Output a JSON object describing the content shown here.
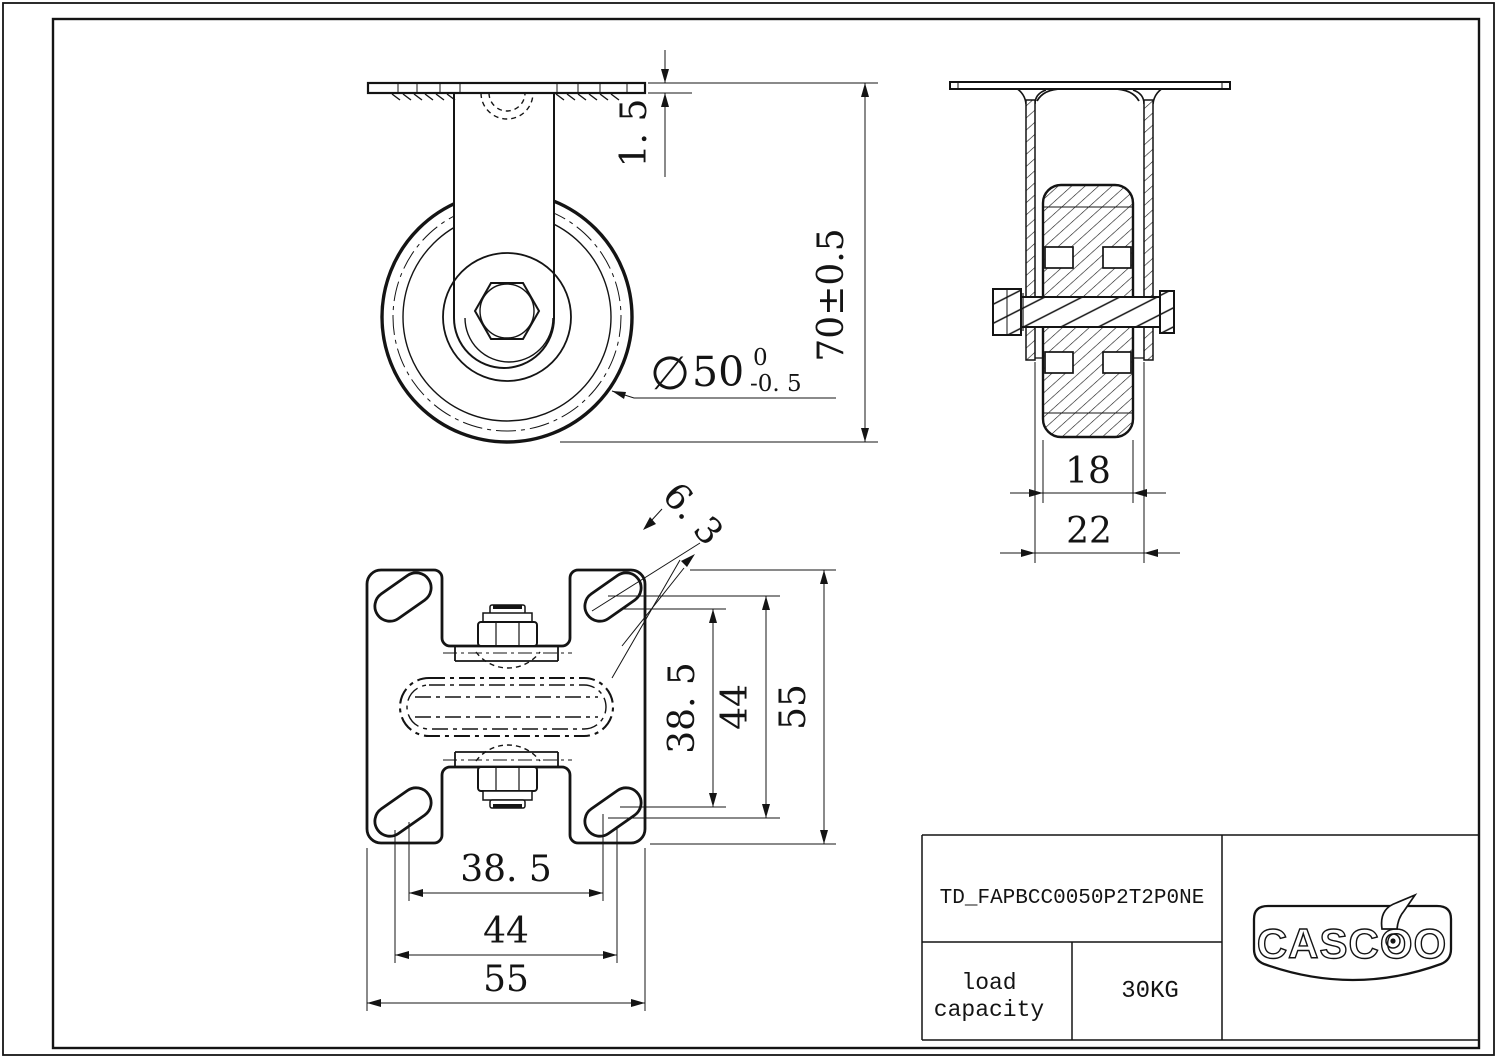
{
  "page": {
    "background": "#ffffff",
    "line_color": "#141414"
  },
  "front_view": {
    "dim_plate_thickness": "1. 5",
    "dim_overall_height": "70±0.5",
    "dim_wheel_diameter_symbol": "∅",
    "dim_wheel_diameter_value": "50",
    "dim_wheel_diameter_tol_upper": "0",
    "dim_wheel_diameter_tol_lower": "-0. 5"
  },
  "side_view": {
    "dim_wheel_width": "18",
    "dim_fork_span": "22"
  },
  "plate_view": {
    "dim_slot_width": "6. 3",
    "dim_bolt_pitch_vertical": "38. 5",
    "dim_slot_span_vertical": "44",
    "dim_plate_size_vertical": "55",
    "dim_bolt_pitch_horizontal": "38. 5",
    "dim_slot_span_horizontal": "44",
    "dim_plate_size_horizontal": "55"
  },
  "title_block": {
    "part_number": "TD_FAPBCC0050P2T2P0NE",
    "load_capacity_line1": "load",
    "load_capacity_line2": "capacity",
    "load_capacity_value": "30KG",
    "brand": "CASCOO"
  }
}
